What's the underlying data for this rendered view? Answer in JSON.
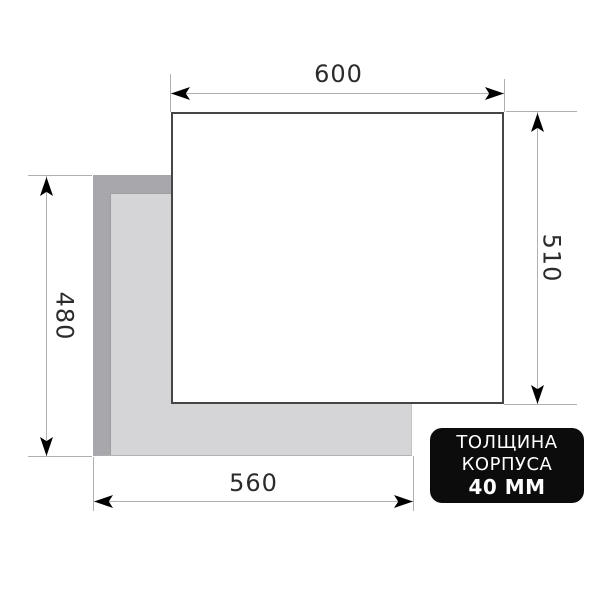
{
  "diagram": {
    "dim_top": "600",
    "dim_right": "510",
    "dim_left": "480",
    "dim_bottom": "560",
    "badge": {
      "line1": "ТОЛЩИНА",
      "line2": "КОРПУСА",
      "line3": "40 ММ"
    },
    "colors": {
      "cutout_bevel": "#a8a8ac",
      "cutout_fill": "#d5d5d7",
      "panel_fill": "#ffffff",
      "panel_outline": "#454545",
      "dimension_line": "#b0b0b0",
      "arrowhead": "#000000",
      "label_text": "#2b2b2b",
      "badge_background": "#0c0c0c",
      "badge_text": "#ffffff"
    }
  }
}
